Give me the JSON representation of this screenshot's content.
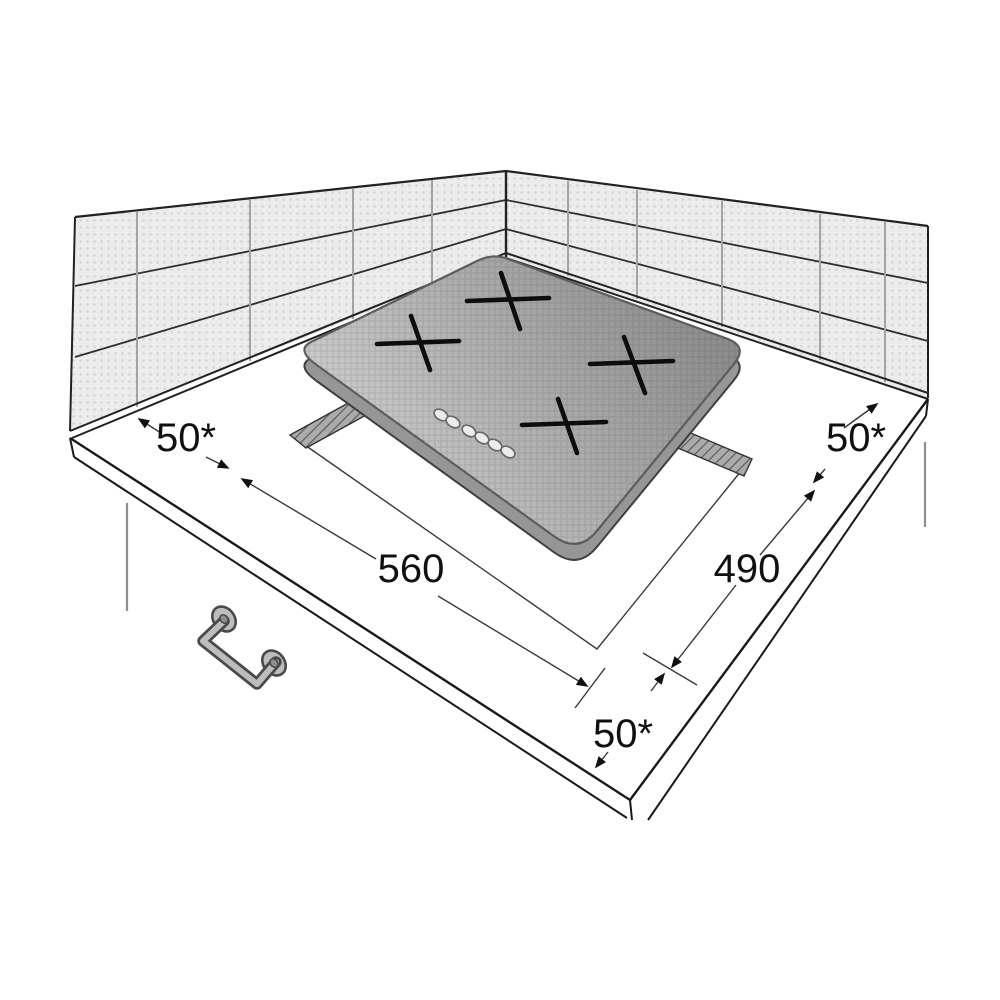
{
  "diagram": {
    "type": "appliance-installation-drawing",
    "subject": "built-in hob in corner worktop with cutout",
    "dimensions": {
      "clearance_wall_left": "50*",
      "clearance_wall_right": "50*",
      "clearance_front": "50*",
      "cutout_width": "560",
      "cutout_depth": "490"
    },
    "burner_count": 4,
    "control_button_count": 6
  },
  "colors": {
    "line": "#1c1c1c",
    "dim_line": "#3a3a3a",
    "wall_fill": "#ececec",
    "wall_dot": "#d2d2d2",
    "counter_fill": "#ffffff",
    "hob_light": "#cfcfcf",
    "hob_dark": "#8c8c8c",
    "hob_side": "#969696",
    "hatch_fill": "#ababab",
    "handle_fill": "#bdbdbd"
  }
}
